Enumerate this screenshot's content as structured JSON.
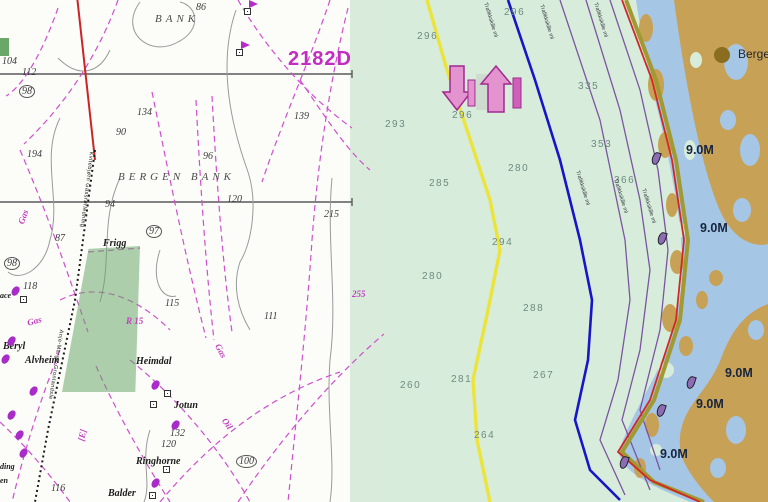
{
  "left_chart": {
    "type": "paper-chart",
    "chart_number": {
      "t": "2182D",
      "x": 288,
      "y": 48
    },
    "labels": [
      {
        "t": "86",
        "x": 196,
        "y": 2,
        "c": "snd"
      },
      {
        "t": "BANK",
        "x": 155,
        "y": 13,
        "c": "area"
      },
      {
        "t": "104",
        "x": 2,
        "y": 56,
        "c": "snd"
      },
      {
        "t": "112",
        "x": 22,
        "y": 67,
        "c": "snd"
      },
      {
        "t": "98",
        "x": 19,
        "y": 85,
        "c": "snd circ"
      },
      {
        "t": "134",
        "x": 137,
        "y": 107,
        "c": "snd"
      },
      {
        "t": "90",
        "x": 116,
        "y": 127,
        "c": "snd"
      },
      {
        "t": "139",
        "x": 294,
        "y": 111,
        "c": "snd"
      },
      {
        "t": "194",
        "x": 27,
        "y": 149,
        "c": "snd"
      },
      {
        "t": "96",
        "x": 203,
        "y": 151,
        "c": "snd"
      },
      {
        "t": "BERGEN BANK",
        "x": 118,
        "y": 171,
        "c": "area"
      },
      {
        "t": "120",
        "x": 227,
        "y": 194,
        "c": "snd"
      },
      {
        "t": "94",
        "x": 105,
        "y": 199,
        "c": "snd"
      },
      {
        "t": "215",
        "x": 324,
        "y": 209,
        "c": "snd"
      },
      {
        "t": "97",
        "x": 146,
        "y": 225,
        "c": "snd circ"
      },
      {
        "t": "87",
        "x": 55,
        "y": 233,
        "c": "snd"
      },
      {
        "t": "Frigg",
        "x": 103,
        "y": 238,
        "c": "place"
      },
      {
        "t": "98",
        "x": 4,
        "y": 257,
        "c": "snd circ"
      },
      {
        "t": "118",
        "x": 23,
        "y": 281,
        "c": "snd"
      },
      {
        "t": "ace",
        "x": 0,
        "y": 291,
        "c": "place sm"
      },
      {
        "t": "115",
        "x": 165,
        "y": 298,
        "c": "snd"
      },
      {
        "t": "111",
        "x": 264,
        "y": 311,
        "c": "snd"
      },
      {
        "t": "255",
        "x": 352,
        "y": 289,
        "c": "mgt"
      },
      {
        "t": "R 15",
        "x": 126,
        "y": 316,
        "c": "mgt"
      },
      {
        "t": "Beryl",
        "x": 3,
        "y": 341,
        "c": "place"
      },
      {
        "t": "Alvheim",
        "x": 25,
        "y": 355,
        "c": "place"
      },
      {
        "t": "Heimdal",
        "x": 136,
        "y": 356,
        "c": "place"
      },
      {
        "t": "Jotun",
        "x": 174,
        "y": 400,
        "c": "place"
      },
      {
        "t": "132",
        "x": 170,
        "y": 428,
        "c": "snd"
      },
      {
        "t": "120",
        "x": 161,
        "y": 439,
        "c": "snd"
      },
      {
        "t": "Ringhorne",
        "x": 136,
        "y": 456,
        "c": "place"
      },
      {
        "t": "100",
        "x": 236,
        "y": 455,
        "c": "snd circ"
      },
      {
        "t": "116",
        "x": 51,
        "y": 483,
        "c": "snd"
      },
      {
        "t": "Balder",
        "x": 108,
        "y": 488,
        "c": "place"
      },
      {
        "t": "ding",
        "x": 0,
        "y": 462,
        "c": "place sm"
      },
      {
        "t": "en",
        "x": 0,
        "y": 476,
        "c": "place sm"
      },
      {
        "t": "Gas",
        "x": 16,
        "y": 222,
        "c": "mgt",
        "r": -70
      },
      {
        "t": "Gas",
        "x": 26,
        "y": 318,
        "c": "mgt sm",
        "r": -15
      },
      {
        "t": "Gas",
        "x": 222,
        "y": 342,
        "c": "mgt",
        "r": 62
      },
      {
        "t": "Oil",
        "x": 228,
        "y": 416,
        "c": "mgt",
        "r": 55
      },
      {
        "t": "[E]",
        "x": 76,
        "y": 440,
        "c": "mgt",
        "r": -78
      },
      {
        "t": "Kvitebjørn Gassrørledning",
        "x": 94,
        "y": 152,
        "c": "pipe",
        "r": 97
      },
      {
        "t": "Anje-Marge-Gronlandsle",
        "x": 64,
        "y": 330,
        "c": "pipe",
        "r": 99
      }
    ],
    "platform_flags": [
      {
        "x": 244,
        "y": 8
      },
      {
        "x": 236,
        "y": 49
      }
    ],
    "boxes": [
      {
        "x": 20,
        "y": 296
      },
      {
        "x": 164,
        "y": 390
      },
      {
        "x": 150,
        "y": 401
      },
      {
        "x": 163,
        "y": 466
      },
      {
        "x": 149,
        "y": 492
      }
    ],
    "blobs": [
      {
        "x": 8,
        "y": 336
      },
      {
        "x": 2,
        "y": 354
      },
      {
        "x": 30,
        "y": 386
      },
      {
        "x": 8,
        "y": 410
      },
      {
        "x": 16,
        "y": 430
      },
      {
        "x": 20,
        "y": 448
      },
      {
        "x": 152,
        "y": 380
      },
      {
        "x": 152,
        "y": 478
      },
      {
        "x": 172,
        "y": 420
      },
      {
        "x": 12,
        "y": 286
      }
    ]
  },
  "right_chart": {
    "type": "ecdis-chart",
    "labels": [
      {
        "t": "296",
        "x": 120,
        "y": 7,
        "c": "dep"
      },
      {
        "t": "296",
        "x": 33,
        "y": 31,
        "c": "dep"
      },
      {
        "t": "293",
        "x": 1,
        "y": 119,
        "c": "dep"
      },
      {
        "t": "296",
        "x": 68,
        "y": 110,
        "c": "dep"
      },
      {
        "t": "285",
        "x": 45,
        "y": 178,
        "c": "dep"
      },
      {
        "t": "280",
        "x": 124,
        "y": 163,
        "c": "dep"
      },
      {
        "t": "335",
        "x": 194,
        "y": 81,
        "c": "dep"
      },
      {
        "t": "353",
        "x": 207,
        "y": 139,
        "c": "dep"
      },
      {
        "t": "366",
        "x": 230,
        "y": 175,
        "c": "dep"
      },
      {
        "t": "294",
        "x": 108,
        "y": 237,
        "c": "dep"
      },
      {
        "t": "280",
        "x": 38,
        "y": 271,
        "c": "dep"
      },
      {
        "t": "288",
        "x": 139,
        "y": 303,
        "c": "dep"
      },
      {
        "t": "260",
        "x": 16,
        "y": 380,
        "c": "dep"
      },
      {
        "t": "281",
        "x": 67,
        "y": 374,
        "c": "dep"
      },
      {
        "t": "267",
        "x": 149,
        "y": 370,
        "c": "dep"
      },
      {
        "t": "264",
        "x": 90,
        "y": 430,
        "c": "dep"
      },
      {
        "t": "9.0M",
        "x": 302,
        "y": 143,
        "c": "nm"
      },
      {
        "t": "9.0M",
        "x": 316,
        "y": 221,
        "c": "nm"
      },
      {
        "t": "9.0M",
        "x": 341,
        "y": 366,
        "c": "nm"
      },
      {
        "t": "9.0M",
        "x": 312,
        "y": 397,
        "c": "nm"
      },
      {
        "t": "9.0M",
        "x": 276,
        "y": 447,
        "c": "nm"
      },
      {
        "t": "Berge",
        "x": 354,
        "y": 47,
        "c": "city"
      },
      {
        "t": "Trafikkskille ml",
        "x": 196,
        "y": 170,
        "c": "linelbl",
        "r": 73
      },
      {
        "t": "Trafikkskille ml",
        "x": 234,
        "y": 178,
        "c": "linelbl",
        "r": 73
      },
      {
        "t": "Trafikkskille ml",
        "x": 262,
        "y": 188,
        "c": "linelbl",
        "r": 73
      },
      {
        "t": "Trafikkskille ml",
        "x": 104,
        "y": 2,
        "c": "linelbl",
        "r": 73
      },
      {
        "t": "Trafikkskille ml",
        "x": 160,
        "y": 4,
        "c": "linelbl",
        "r": 73
      },
      {
        "t": "Trafikkskille ml",
        "x": 214,
        "y": 2,
        "c": "linelbl",
        "r": 73
      }
    ],
    "buoys": [
      {
        "x": 268,
        "y": 152
      },
      {
        "x": 274,
        "y": 232
      },
      {
        "x": 303,
        "y": 376
      },
      {
        "x": 273,
        "y": 404
      },
      {
        "x": 236,
        "y": 456
      }
    ]
  },
  "colors": {
    "paper_bg": "#fcfcf9",
    "magenta": "#bf3fbf",
    "chart_number_magenta": "#c32cc3",
    "paper_red_line": "#cc2424",
    "paper_green_patch": "rgba(106,168,106,.55)",
    "mint_sea": "#d7ecda",
    "coastal_blue": "#a6c6e6",
    "land_tan": "#c7a155",
    "city_dot_brown": "#8a6d1e",
    "contour_yellow": "#ece43a",
    "contour_blue": "#1616c8",
    "contour_purple": "#7c55a2",
    "contour_red": "#d02828",
    "contour_olive": "#a09a30",
    "depth_text": "#6e8a80",
    "nm_text": "#16243e"
  }
}
